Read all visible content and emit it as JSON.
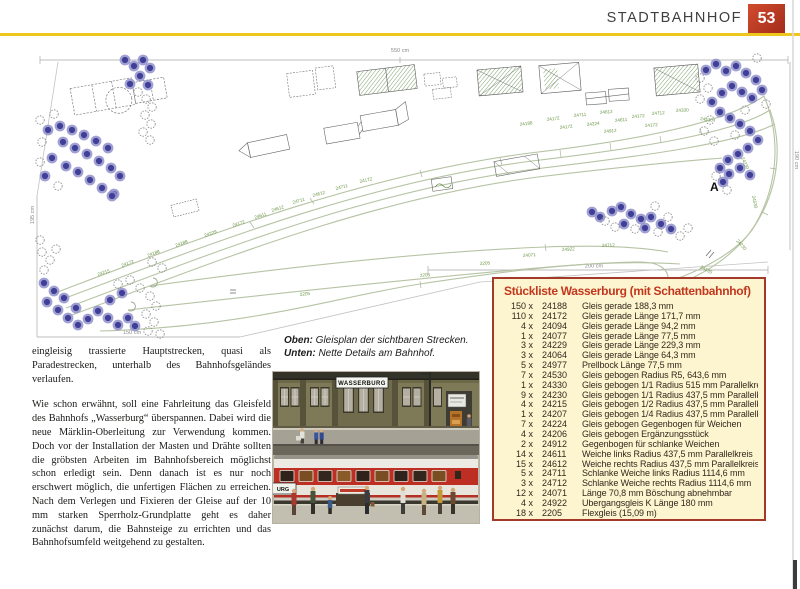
{
  "header": {
    "section_title": "STADTBAHNHOF",
    "page_number": "53"
  },
  "colors": {
    "accent_red": "#b93a22",
    "rule_yellow": "#eec71e",
    "list_bg": "#fdf5d0",
    "list_border": "#a2392a",
    "list_title": "#c2371d",
    "track_line": "#b6c3a4",
    "track_label_green": "#6c9748",
    "tree_blue": "#41419b"
  },
  "diagram": {
    "marker_a": "A",
    "dimensions": {
      "top": "550 cm",
      "left": "195 cm",
      "bottom_left": "150 cm",
      "bottom_right": "200 cm",
      "right": "190 cm"
    },
    "track_labels": [
      {
        "t": "24215",
        "x": 98,
        "y": 276,
        "r": -18
      },
      {
        "t": "24172",
        "x": 122,
        "y": 267,
        "r": -20
      },
      {
        "t": "24188",
        "x": 148,
        "y": 257,
        "r": -20
      },
      {
        "t": "24188",
        "x": 176,
        "y": 247,
        "r": -20
      },
      {
        "t": "24229",
        "x": 205,
        "y": 237,
        "r": -19
      },
      {
        "t": "24172",
        "x": 233,
        "y": 227,
        "r": -18
      },
      {
        "t": "24611",
        "x": 255,
        "y": 219,
        "r": -18
      },
      {
        "t": "24612",
        "x": 272,
        "y": 212,
        "r": -17
      },
      {
        "t": "24711",
        "x": 293,
        "y": 204,
        "r": -16
      },
      {
        "t": "24612",
        "x": 313,
        "y": 197,
        "r": -15
      },
      {
        "t": "24711",
        "x": 336,
        "y": 190,
        "r": -14
      },
      {
        "t": "24172",
        "x": 360,
        "y": 183,
        "r": -13
      },
      {
        "t": "2205",
        "x": 300,
        "y": 296,
        "r": -6
      },
      {
        "t": "2205",
        "x": 420,
        "y": 277,
        "r": -5
      },
      {
        "t": "2205",
        "x": 480,
        "y": 265,
        "r": -4
      },
      {
        "t": "24071",
        "x": 523,
        "y": 257,
        "r": -4
      },
      {
        "t": "24922",
        "x": 562,
        "y": 251,
        "r": -3
      },
      {
        "t": "24712",
        "x": 602,
        "y": 247,
        "r": -2
      },
      {
        "t": "24188",
        "x": 520,
        "y": 126,
        "r": -8
      },
      {
        "t": "24172",
        "x": 547,
        "y": 121,
        "r": -7
      },
      {
        "t": "24711",
        "x": 574,
        "y": 117,
        "r": -6
      },
      {
        "t": "24172",
        "x": 560,
        "y": 129,
        "r": -6
      },
      {
        "t": "24224",
        "x": 587,
        "y": 126,
        "r": -6
      },
      {
        "t": "24612",
        "x": 600,
        "y": 114,
        "r": -5
      },
      {
        "t": "24611",
        "x": 615,
        "y": 122,
        "r": -5
      },
      {
        "t": "24172",
        "x": 632,
        "y": 118,
        "r": -4
      },
      {
        "t": "24912",
        "x": 604,
        "y": 133,
        "r": -5
      },
      {
        "t": "24712",
        "x": 652,
        "y": 115,
        "r": -4
      },
      {
        "t": "24172",
        "x": 645,
        "y": 127,
        "r": -4
      },
      {
        "t": "24330",
        "x": 676,
        "y": 112,
        "r": -3
      },
      {
        "t": "24530",
        "x": 700,
        "y": 120,
        "r": 8
      },
      {
        "t": "24230",
        "x": 741,
        "y": 158,
        "r": 65
      },
      {
        "t": "24530",
        "x": 752,
        "y": 196,
        "r": 78
      },
      {
        "t": "24230",
        "x": 736,
        "y": 241,
        "r": 48
      },
      {
        "t": "24530",
        "x": 700,
        "y": 268,
        "r": 28
      }
    ]
  },
  "caption": {
    "line1_lead": "Oben:",
    "line1_text": " Gleisplan der sichtbaren Strecken.",
    "line2_lead": "Unten:",
    "line2_text": " Nette Details am Bahnhof."
  },
  "article": {
    "para1": "eingleisig trassierte Hauptstrecken, quasi als Paradestrecken, unterhalb des Bahnhofsgeländes verlaufen.",
    "para2": "Wie schon erwähnt, soll eine Fahrleitung das Gleisfeld des Bahnhofs „Wasserburg“ überspannen. Dabei wird die neue Märklin-Oberleitung zur Verwendung kommen. Doch vor der Installation der Masten und Drähte sollten die gröbsten Arbeiten im Bahnhofsbereich möglichst schon erledigt sein. Denn danach ist es nur noch erschwert möglich, die unfertigen Flächen zu erreichen. Nach dem Verlegen und Fixieren der Gleise auf der 10 mm starken Sperrholz-Grundplatte geht es daher zunächst darum, die Bahnsteige zu errichten und das Bahnhofsumfeld weitgehend zu gestalten."
  },
  "photo": {
    "station_sign": "WASSERBURG",
    "partial_sign": "URG"
  },
  "parts_list": {
    "title": "Stückliste Wasserburg (mit Schattenbahnhof)",
    "items": [
      {
        "qty": "150 x",
        "code": "24188",
        "desc": "Gleis gerade 188,3 mm"
      },
      {
        "qty": "110 x",
        "code": "24172",
        "desc": "Gleis gerade Länge 171,7 mm"
      },
      {
        "qty": "4 x",
        "code": "24094",
        "desc": "Gleis gerade Länge 94,2 mm"
      },
      {
        "qty": "1 x",
        "code": "24077",
        "desc": "Gleis gerade Länge 77,5 mm"
      },
      {
        "qty": "3 x",
        "code": "24229",
        "desc": "Gleis gerade Länge 229,3 mm"
      },
      {
        "qty": "3 x",
        "code": "24064",
        "desc": "Gleis gerade Länge 64,3 mm"
      },
      {
        "qty": "5 x",
        "code": "24977",
        "desc": "Prellbock Länge 77,5 mm"
      },
      {
        "qty": "7 x",
        "code": "24530",
        "desc": "Gleis gebogen Radius R5, 643,6 mm"
      },
      {
        "qty": "1 x",
        "code": "24330",
        "desc": "Gleis gebogen 1/1 Radius 515 mm Parallelkreis"
      },
      {
        "qty": "9 x",
        "code": "24230",
        "desc": "Gleis gebogen 1/1 Radius 437,5 mm Parallelkreis"
      },
      {
        "qty": "4 x",
        "code": "24215",
        "desc": "Gleis gebogen 1/2 Radius 437,5 mm Parallelkreis"
      },
      {
        "qty": "1 x",
        "code": "24207",
        "desc": "Gleis gebogen 1/4 Radius 437,5 mm Parallelkreis"
      },
      {
        "qty": "7 x",
        "code": "24224",
        "desc": "Gleis gebogen Gegenbogen für Weichen"
      },
      {
        "qty": "4 x",
        "code": "24206",
        "desc": "Gleis gebogen Ergänzungsstück"
      },
      {
        "qty": "2 x",
        "code": "24912",
        "desc": "Gegenbogen für schlanke Weichen"
      },
      {
        "qty": "14 x",
        "code": "24611",
        "desc": "Weiche links Radius 437,5 mm Parallelkreis"
      },
      {
        "qty": "15 x",
        "code": "24612",
        "desc": "Weiche rechts Radius 437,5 mm Parallelkreis"
      },
      {
        "qty": "5 x",
        "code": "24711",
        "desc": "Schlanke Weiche links Radius 1114,6 mm"
      },
      {
        "qty": "3 x",
        "code": "24712",
        "desc": "Schlanke Weiche rechts Radius 1114,6 mm"
      },
      {
        "qty": "12 x",
        "code": "24071",
        "desc": "Länge 70,8 mm Böschung abnehmbar"
      },
      {
        "qty": "4 x",
        "code": "24922",
        "desc": "Übergangsgleis K Länge 180 mm"
      },
      {
        "qty": "18 x",
        "code": "2205",
        "desc": "Flexgleis (15,09 m)"
      }
    ]
  }
}
